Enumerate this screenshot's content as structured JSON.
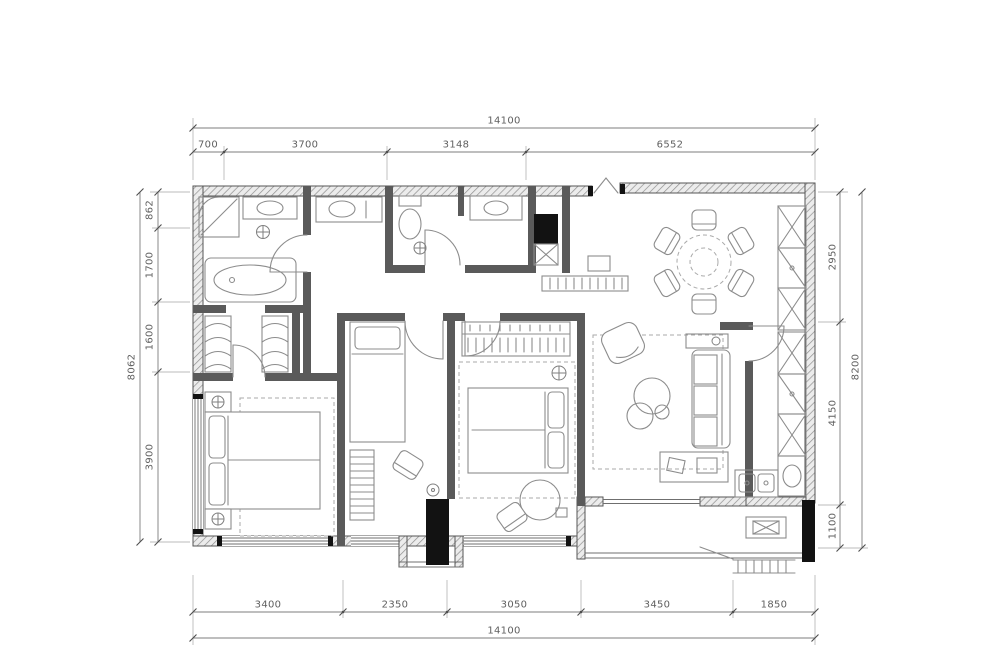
{
  "title": "apartment-floor-plan",
  "colors": {
    "background": "#ffffff",
    "wall": "#5a5a5a",
    "furniture_line": "#8c8c8c",
    "dimension_line": "#7d7d7d",
    "dimension_text": "#5f5f5f",
    "solid_fill": "#121212"
  },
  "dimensions": {
    "top": {
      "total": "14100",
      "segments": [
        "700",
        "3700",
        "3148",
        "6552"
      ]
    },
    "bottom": {
      "total": "14100",
      "segments": [
        "3400",
        "2350",
        "3050",
        "3450",
        "1850"
      ]
    },
    "left": {
      "total": "8062",
      "segments": [
        "862",
        "1700",
        "1600",
        "3900"
      ]
    },
    "right": {
      "total": "8200",
      "segments": [
        "2950",
        "4150",
        "1100"
      ]
    }
  }
}
